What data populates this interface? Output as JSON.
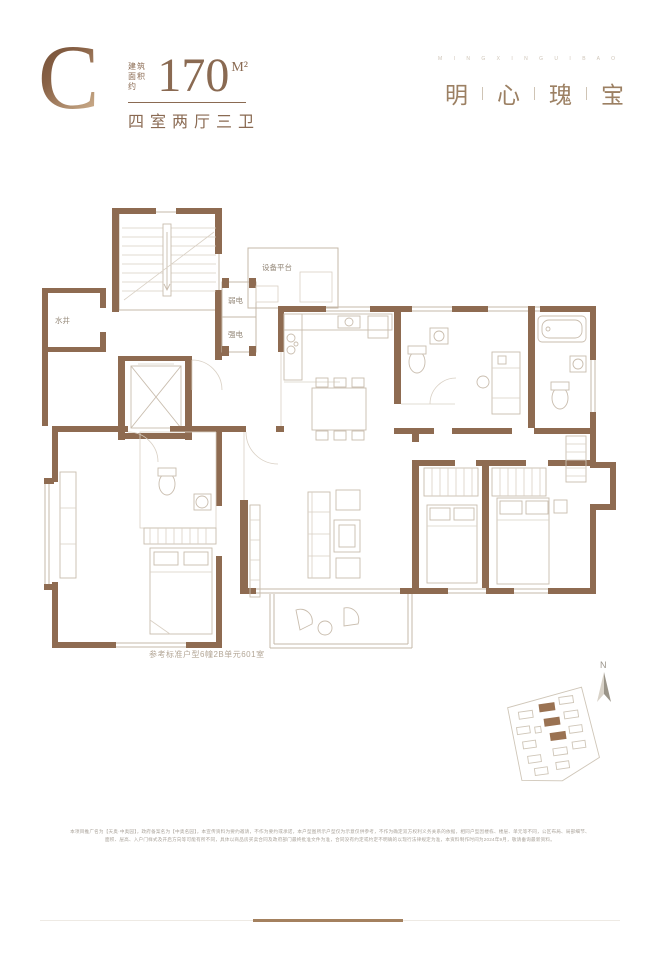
{
  "header": {
    "type_letter": "C",
    "area_label_l1": "建筑",
    "area_label_l2": "面积约",
    "area_value": "170",
    "area_unit": "M²",
    "layout_text": "四室两厅三卫"
  },
  "brand": {
    "tagline": "M I N G X I N G U I B A O",
    "chars": [
      "明",
      "心",
      "瑰",
      "宝"
    ]
  },
  "plan": {
    "labels": {
      "water_well": "水井",
      "weak_power": "弱电",
      "strong_power": "强电",
      "equipment_platform": "设备平台"
    },
    "caption": "参考标准户型6幢2B单元601室"
  },
  "compass": {
    "north": "N"
  },
  "disclaimer": {
    "line1": "本项目推广名为【天奥·中奥园】，政府备案名为【中奥名园】，本宣传资料为要约邀请，不作为要约或承诺，本户型图所示户型仅为示意仅供参考，不作为确定双方权利义务关系的依据，相同户型因楼栋、楼层、单元等不同，公区布局、局部细节、",
    "line2": "面积、层高、入户门样式及开启方向等可能有所不同，具体以商品房买卖合同及政府部门最终批准文件为准，合同没有约定或约定不明确的以现行法律规定为准，本资料制作时间为2024年9月，敬请垂询最新资料。"
  },
  "colors": {
    "wall_brown": "#8e6b51",
    "accent_brown": "#8a6a52",
    "brand_brown": "#9c8063",
    "site_highlight": "#9a7252"
  }
}
